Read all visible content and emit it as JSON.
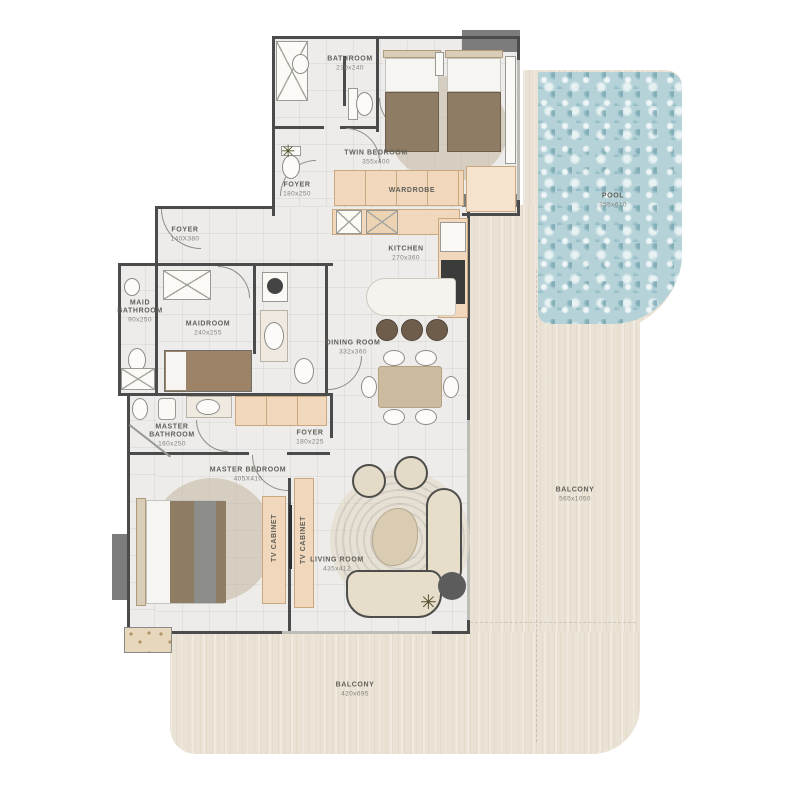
{
  "colors": {
    "balcony": "#eae2d4",
    "pool": "#b4d2d8",
    "floor": "#edecea",
    "wall": "#4b4b4b",
    "cabinet_peach": "#f1d8bc",
    "bed_blanket": "#8f7c64",
    "sofa": "#e6ddcb"
  },
  "rooms": [
    {
      "id": "bathroom",
      "name": "BATHROOM",
      "dims": "210x240",
      "x": 350,
      "y": 64
    },
    {
      "id": "twin-bedroom",
      "name": "TWIN BEDROOM",
      "dims": "355x400",
      "x": 376,
      "y": 158
    },
    {
      "id": "foyer-upper",
      "name": "FOYER",
      "dims": "180x250",
      "x": 297,
      "y": 190
    },
    {
      "id": "wardrobe",
      "name": "WARDROBE",
      "dims": "",
      "x": 412,
      "y": 191
    },
    {
      "id": "foyer-entry",
      "name": "FOYER",
      "dims": "140X380",
      "x": 185,
      "y": 235
    },
    {
      "id": "kitchen",
      "name": "KITCHEN",
      "dims": "270x360",
      "x": 406,
      "y": 254
    },
    {
      "id": "maid-bathroom",
      "name": "MAID BATHROOM",
      "dims": "90x250",
      "x": 140,
      "y": 312,
      "w": 50
    },
    {
      "id": "maidroom",
      "name": "MAIDROOM",
      "dims": "240x255",
      "x": 208,
      "y": 329
    },
    {
      "id": "dining-room",
      "name": "DINING ROOM",
      "dims": "332x360",
      "x": 353,
      "y": 348
    },
    {
      "id": "master-bathroom",
      "name": "MASTER BATHROOM",
      "dims": "160x250",
      "x": 172,
      "y": 436,
      "w": 54
    },
    {
      "id": "foyer-master",
      "name": "FOYER",
      "dims": "180x225",
      "x": 310,
      "y": 438
    },
    {
      "id": "master-bedroom",
      "name": "MASTER BEDROOM",
      "dims": "405X410",
      "x": 248,
      "y": 475
    },
    {
      "id": "living-room",
      "name": "LIVING ROOM",
      "dims": "435x412",
      "x": 337,
      "y": 565
    },
    {
      "id": "tv-cabinet-1",
      "name": "TV CABINET",
      "dims": "",
      "x": 275,
      "y": 538,
      "vertical": true
    },
    {
      "id": "tv-cabinet-2",
      "name": "TV CABINET",
      "dims": "",
      "x": 304,
      "y": 540,
      "vertical": true
    },
    {
      "id": "pool",
      "name": "POOL",
      "dims": "355x610",
      "x": 613,
      "y": 201
    },
    {
      "id": "balcony-right",
      "name": "BALCONY",
      "dims": "565x1050",
      "x": 575,
      "y": 495
    },
    {
      "id": "balcony-bottom",
      "name": "BALCONY",
      "dims": "420x695",
      "x": 355,
      "y": 690
    }
  ]
}
